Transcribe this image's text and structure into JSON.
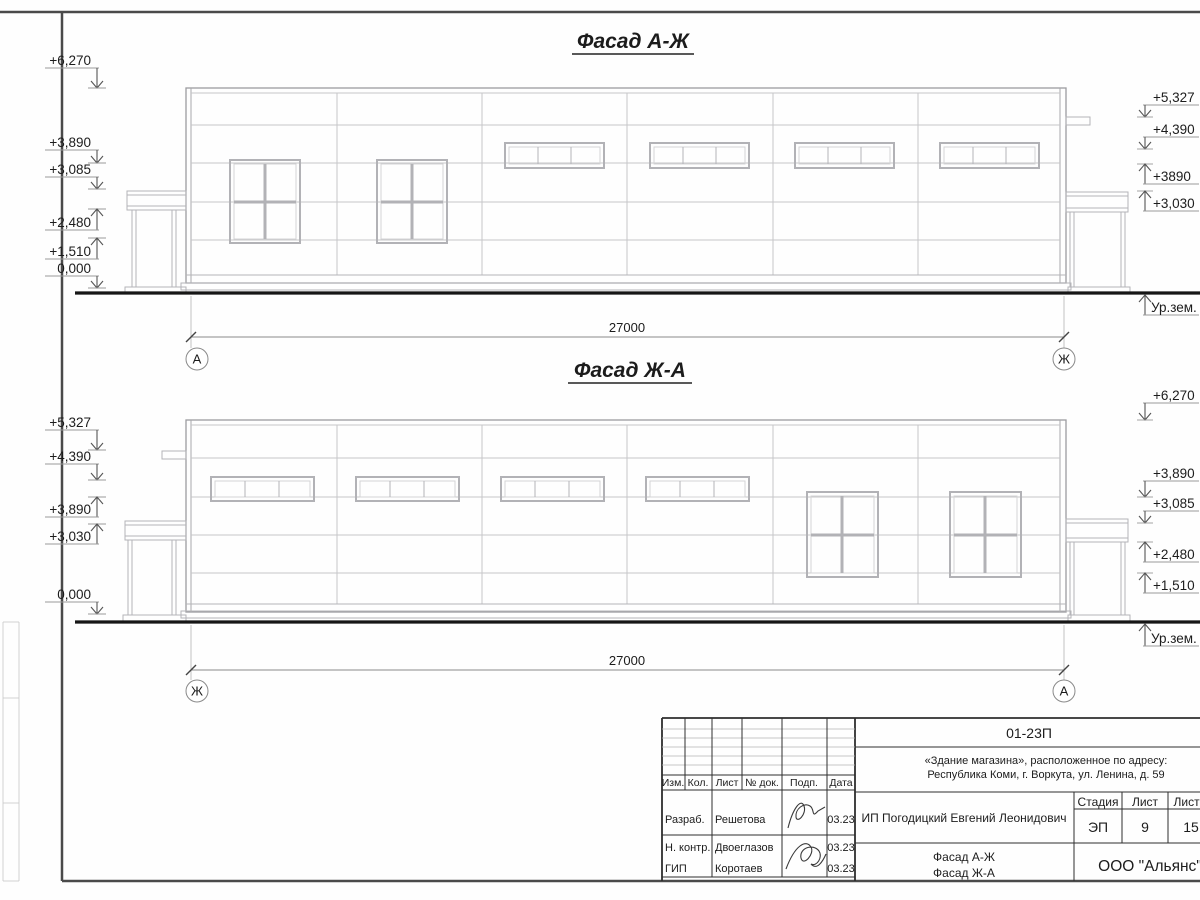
{
  "sheet": {
    "facades": [
      {
        "title": "Фасад А-Ж",
        "dimension_label": "27000",
        "grid_left": "А",
        "grid_right": "Ж",
        "ground_label": "Ур.зем.",
        "left_marks": [
          "+6,270",
          "+3,890",
          "+3,085",
          "+2,480",
          "+1,510",
          "0,000"
        ],
        "right_marks": [
          "+5,327",
          "+4,390",
          "+3890",
          "+3,030"
        ]
      },
      {
        "title": "Фасад Ж-А",
        "dimension_label": "27000",
        "grid_left": "Ж",
        "grid_right": "А",
        "ground_label": "Ур.зем.",
        "left_marks": [
          "+5,327",
          "+4,390",
          "+3,890",
          "+3,030",
          "0,000"
        ],
        "right_marks": [
          "+6,270",
          "+3,890",
          "+3,085",
          "+2,480",
          "+1,510"
        ]
      }
    ]
  },
  "title_block": {
    "doc_number": "01-23П",
    "object_line1": "«Здание магазина», расположенное по адресу:",
    "object_line2": "Республика Коми, г. Воркута, ул. Ленина, д. 59",
    "header_cols": [
      "Изм.",
      "Кол.",
      "Лист",
      "№ док.",
      "Подп.",
      "Дата"
    ],
    "rows": [
      {
        "role": "Разраб.",
        "name": "Решетова",
        "date": "03.23"
      },
      {
        "role": "Н. контр.",
        "name": "Двоеглазов",
        "date": "03.23"
      },
      {
        "role": "ГИП",
        "name": "Коротаев",
        "date": "03.23"
      }
    ],
    "client": "ИП Погодицкий Евгений Леонидович",
    "stage_label": "Стадия",
    "sheet_label": "Лист",
    "sheets_label": "Листов",
    "stage": "ЭП",
    "sheet_no": "9",
    "sheets_total": "15",
    "drawing_title_line1": "Фасад А-Ж",
    "drawing_title_line2": "Фасад Ж-А",
    "organization": "ООО \"Альянс\""
  }
}
